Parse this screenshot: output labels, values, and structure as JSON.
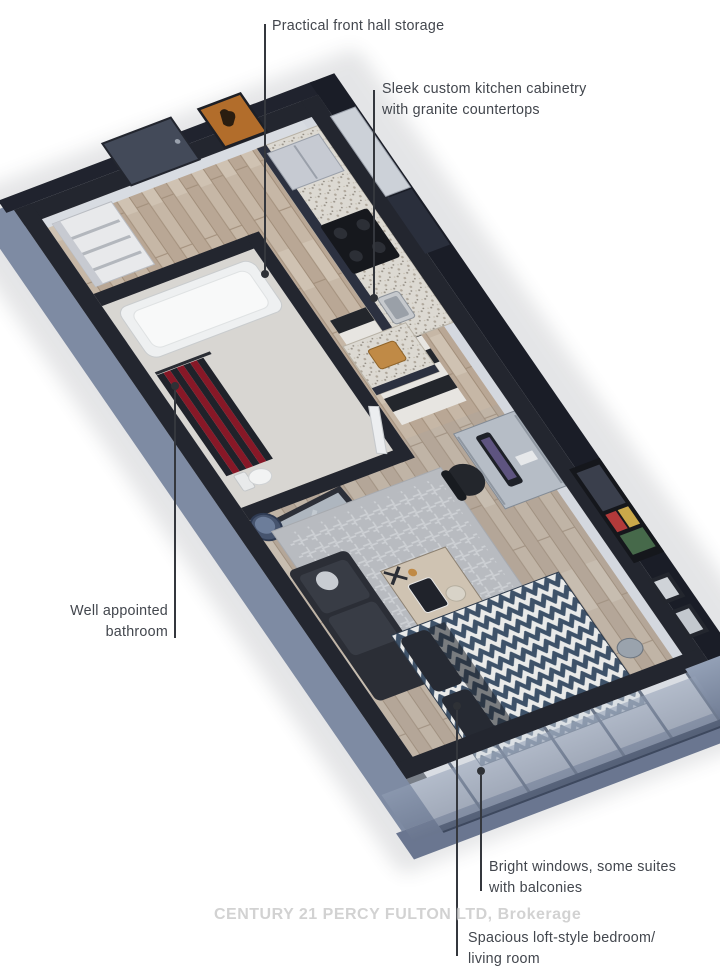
{
  "figure": {
    "type": "isometric-floorplan-rendering",
    "description_names": [
      "entry-hall",
      "front-hall-storage",
      "bathroom",
      "kitchen",
      "living-bedroom",
      "windows",
      "balcony"
    ]
  },
  "annotations": {
    "front_hall": {
      "text": "Practical front hall storage"
    },
    "kitchen": {
      "line1": "Sleek custom kitchen cabinetry",
      "line2": "with granite countertops"
    },
    "bathroom": {
      "line1": "Well appointed",
      "line2": "bathroom"
    },
    "windows": {
      "line1": "Bright windows, some suites",
      "line2": "with balconies"
    },
    "loft": {
      "line1": "Spacious loft-style bedroom/",
      "line2": "living room"
    }
  },
  "watermark": {
    "text": "CENTURY 21 PERCY FULTON LTD, Brokerage"
  },
  "palette": {
    "wall_dark": "#23262f",
    "wall_outer_slate": "#7e8ba3",
    "wall_face_light": "#d6dae0",
    "floor_wood": "#c3b2a0",
    "bath_floor": "#d8d6d2",
    "rug": "#b8bbc0",
    "sofa": "#2b2e36",
    "bed_navy": "#3e5269",
    "bed_white": "#e9eae9",
    "curtain_black": "#1f222a",
    "curtain_red": "#871827",
    "cabinet_navy": "#343b4c",
    "granite": "#dcd9d2",
    "poster_orange": "#b26d2b",
    "window_glass": "#c9d4dd",
    "label_text": "#42464d",
    "leader": "#34373d",
    "watermark_gray": "#c9c9c9"
  }
}
